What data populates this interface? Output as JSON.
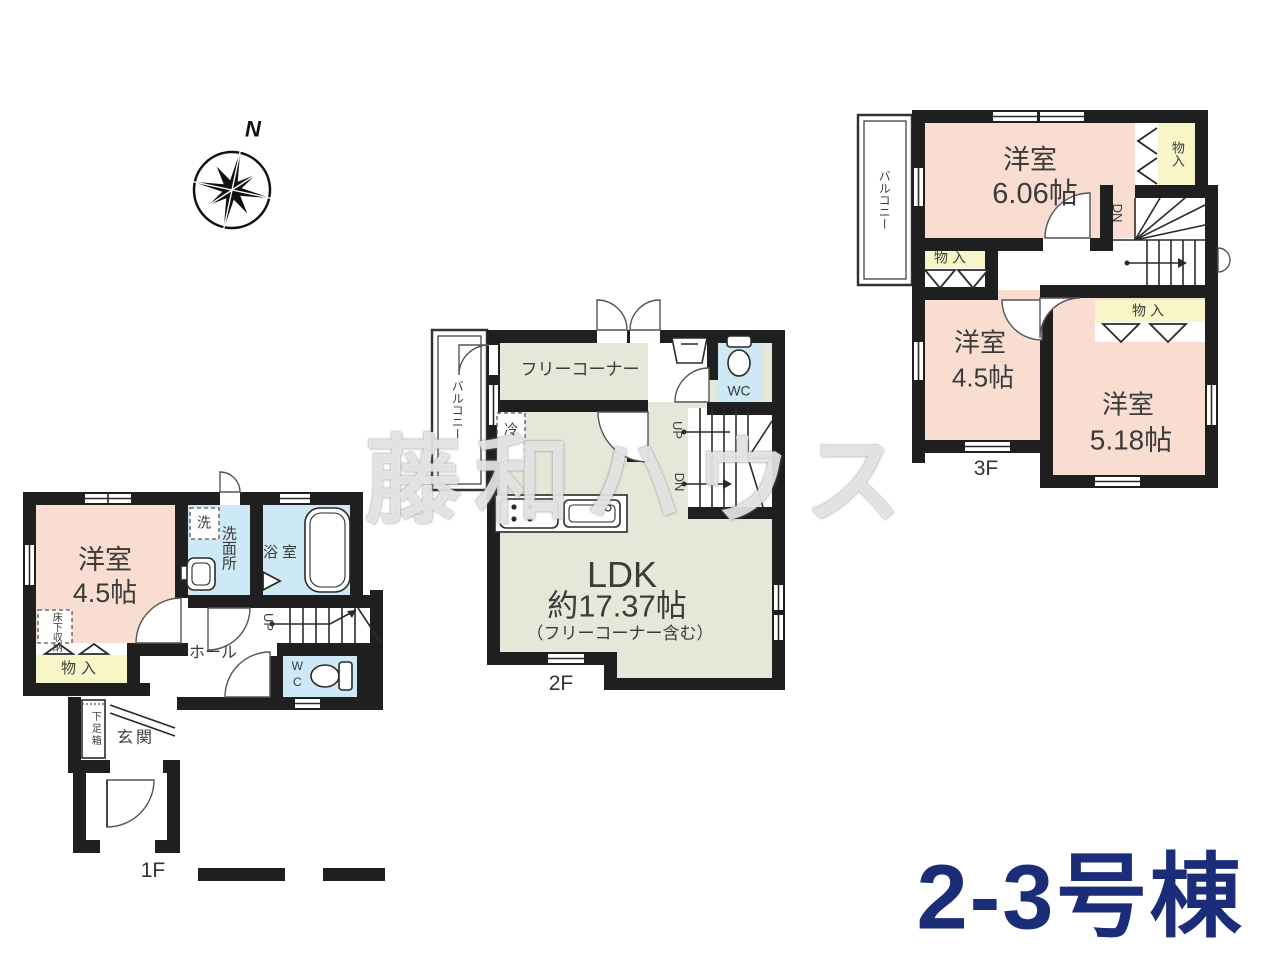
{
  "title": {
    "text": "2-3号棟",
    "color": "#1b2d78"
  },
  "watermark": {
    "text": "藤和ハウス"
  },
  "compass": {
    "north": "N"
  },
  "colors": {
    "wall": "#1f1f1f",
    "room_pink": "#f9ddd0",
    "closet_yellow": "#f8f6c9",
    "wet_blue": "#cde9f6",
    "ldk_green": "#e6e7d8",
    "title_navy": "#1b2d78"
  },
  "floor1": {
    "name": "1F",
    "labels": {
      "western_room": "洋室",
      "western_room_size": "4.5帖",
      "laundry": "洗",
      "washroom": "洗面所",
      "bathroom": "浴室",
      "hall": "ホール",
      "up": "UP",
      "wc": "WC",
      "closet": "物入",
      "underfloor_storage": "床下収納",
      "shoe_box": "下足箱",
      "entrance": "玄関"
    }
  },
  "floor2": {
    "name": "2F",
    "labels": {
      "balcony": "バルコニー",
      "free_corner": "フリーコーナー",
      "fridge": "冷",
      "up": "UP",
      "down": "DN",
      "wc": "WC",
      "ldk": "LDK",
      "ldk_size": "約17.37帖",
      "ldk_note": "（フリーコーナー含む）"
    }
  },
  "floor3": {
    "name": "3F",
    "labels": {
      "balcony": "バルコニー",
      "western_room_1": "洋室",
      "western_room_1_size": "6.06帖",
      "closet_top": "物入",
      "down": "DN",
      "closet_left": "物入",
      "western_room_2": "洋室",
      "western_room_2_size": "4.5帖",
      "closet_right": "物入",
      "western_room_3": "洋室",
      "western_room_3_size": "5.18帖"
    }
  }
}
